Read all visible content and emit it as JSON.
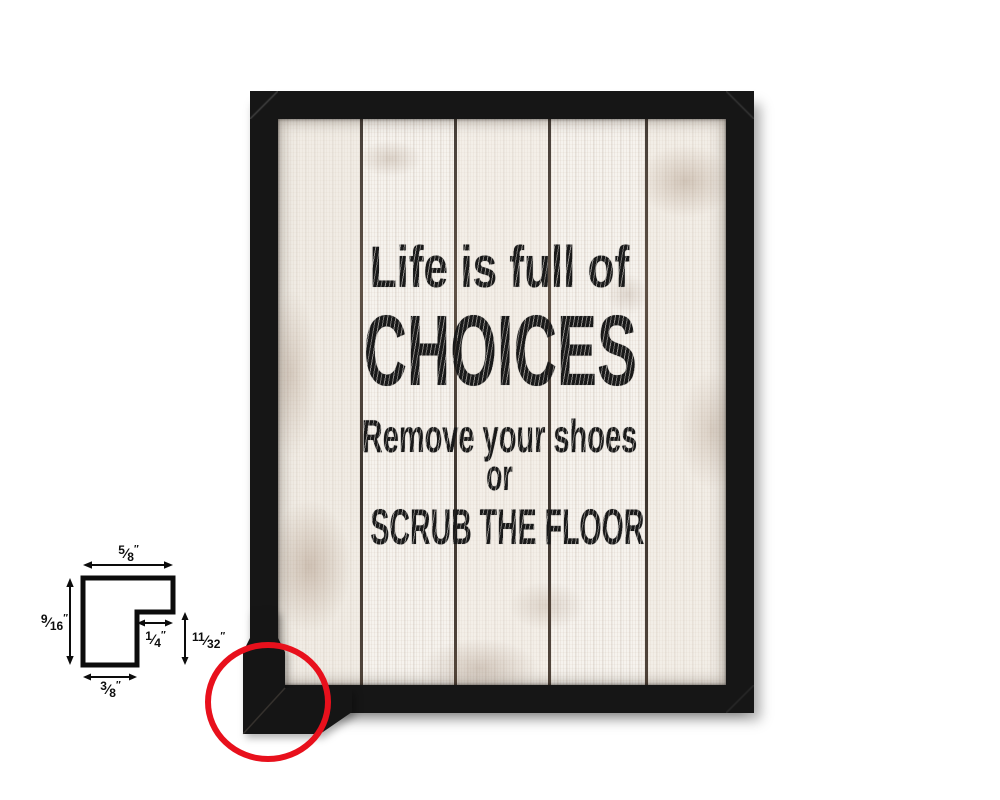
{
  "sign": {
    "lines": [
      "Life is full of",
      "CHOICES",
      "Remove your shoes",
      "or",
      "SCRUB THE FLOOR"
    ]
  },
  "diagram": {
    "fraction_slash": "⁄",
    "measurements": {
      "top_width": {
        "num": "5",
        "den": "8",
        "unit": "″"
      },
      "left_height": {
        "num": "9",
        "den": "16",
        "unit": "″"
      },
      "rabbet_width": {
        "num": "1",
        "den": "4",
        "unit": "″"
      },
      "rabbet_depth": {
        "num": "11",
        "den": "32",
        "unit": "″"
      },
      "bottom_width": {
        "num": "3",
        "den": "8",
        "unit": "″"
      }
    }
  },
  "colors": {
    "frame_black": "#161616",
    "highlight_red": "#e8101c",
    "wood_base": "#f6f3ee",
    "ink": "#191919"
  }
}
